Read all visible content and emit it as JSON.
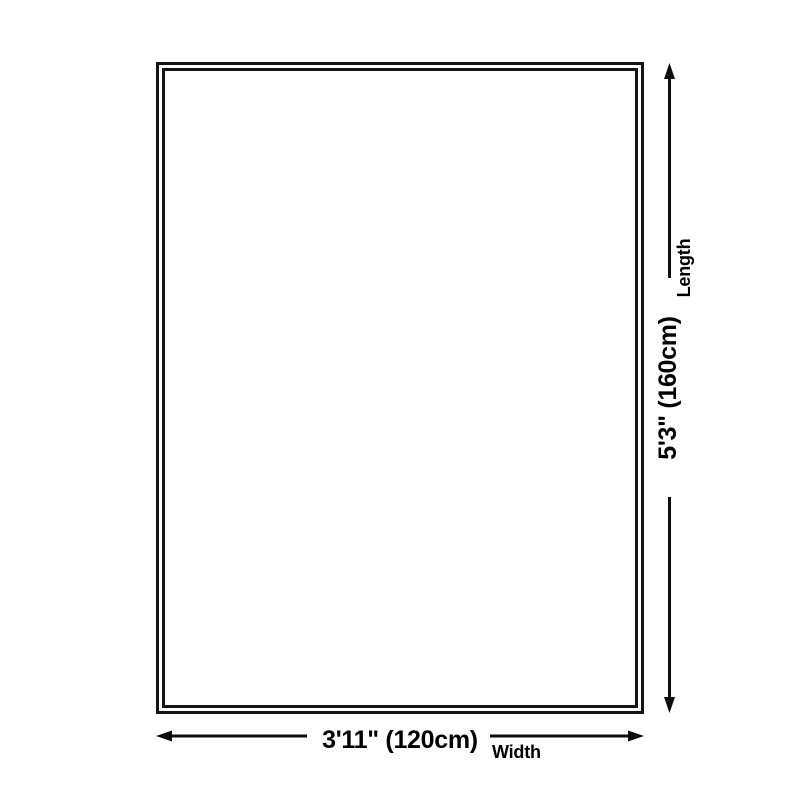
{
  "colors": {
    "background": "#ffffff",
    "line": "#0d0d0d",
    "border": "#151515",
    "text": "#000000"
  },
  "dimensions": {
    "length": {
      "label": "Length",
      "value": "5'3\" (160cm)"
    },
    "width": {
      "label": "Width",
      "value": "3'11\" (120cm)"
    }
  }
}
